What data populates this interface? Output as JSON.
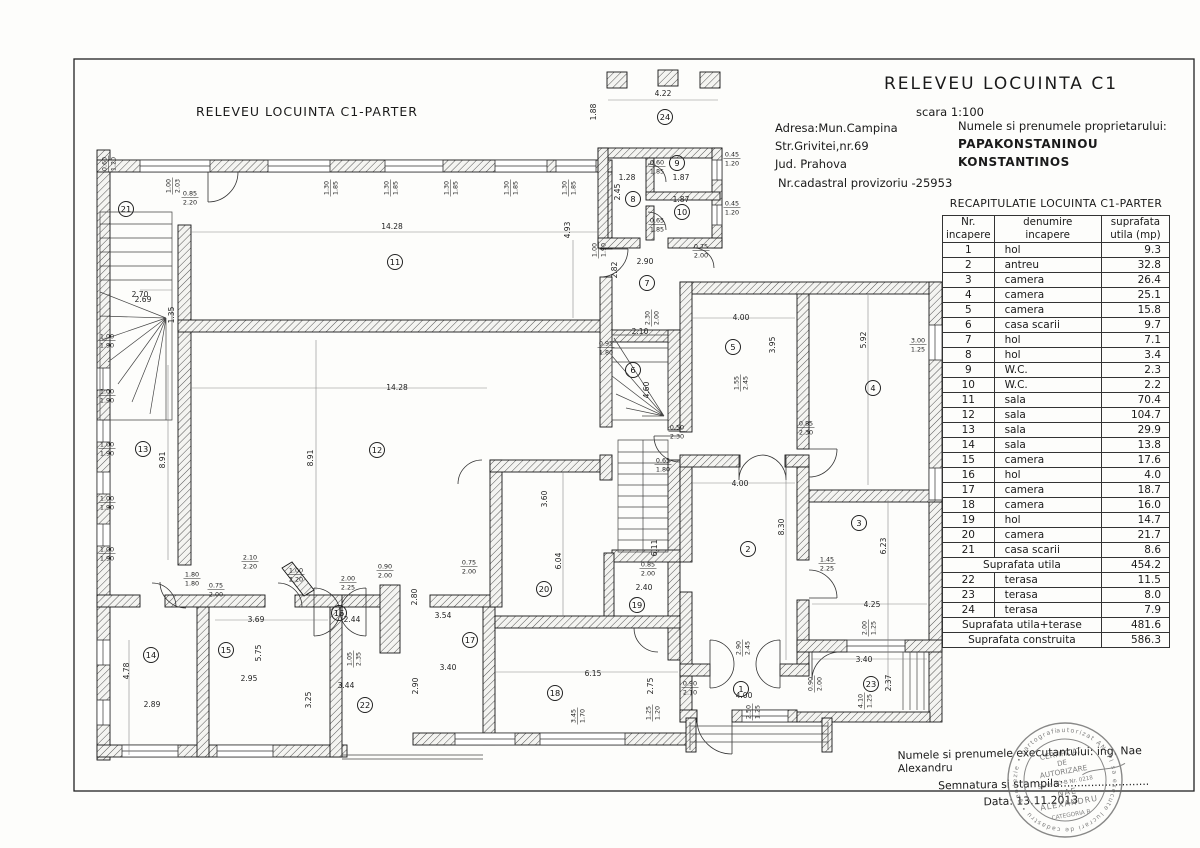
{
  "sheet": {
    "plan_title": "RELEVEU  LOCUINTA C1-PARTER",
    "header": {
      "title": "RELEVEU  LOCUINTA C1",
      "scale": "scara 1:100",
      "address_line1": "Adresa:Mun.Campina",
      "address_line2": "Str.Grivitei,nr.69",
      "address_line3": "Jud. Prahova",
      "cadastral": "Nr.cadastral provizoriu -25953",
      "owner_label": "Numele si prenumele proprietarului:",
      "owner_line1": "PAPAKONSTANINOU",
      "owner_line2": "KONSTANTINOS"
    },
    "recap_table": {
      "title": "RECAPITULATIE LOCUINTA C1-PARTER",
      "headers": {
        "col1a": "Nr.",
        "col1b": "incapere",
        "col2a": "denumire",
        "col2b": "incapere",
        "col3a": "suprafata",
        "col3b": "utila (mp)"
      },
      "rows": [
        {
          "nr": "1",
          "name": "hol",
          "area": "9.3"
        },
        {
          "nr": "2",
          "name": "antreu",
          "area": "32.8"
        },
        {
          "nr": "3",
          "name": "camera",
          "area": "26.4"
        },
        {
          "nr": "4",
          "name": "camera",
          "area": "25.1"
        },
        {
          "nr": "5",
          "name": "camera",
          "area": "15.8"
        },
        {
          "nr": "6",
          "name": "casa scarii",
          "area": "9.7"
        },
        {
          "nr": "7",
          "name": "hol",
          "area": "7.1"
        },
        {
          "nr": "8",
          "name": "hol",
          "area": "3.4"
        },
        {
          "nr": "9",
          "name": "W.C.",
          "area": "2.3"
        },
        {
          "nr": "10",
          "name": "W.C.",
          "area": "2.2"
        },
        {
          "nr": "11",
          "name": "sala",
          "area": "70.4"
        },
        {
          "nr": "12",
          "name": "sala",
          "area": "104.7"
        },
        {
          "nr": "13",
          "name": "sala",
          "area": "29.9"
        },
        {
          "nr": "14",
          "name": "sala",
          "area": "13.8"
        },
        {
          "nr": "15",
          "name": "camera",
          "area": "17.6"
        },
        {
          "nr": "16",
          "name": "hol",
          "area": "4.0"
        },
        {
          "nr": "17",
          "name": "camera",
          "area": "18.7"
        },
        {
          "nr": "18",
          "name": "camera",
          "area": "16.0"
        },
        {
          "nr": "19",
          "name": "hol",
          "area": "14.7"
        },
        {
          "nr": "20",
          "name": "camera",
          "area": "21.7"
        },
        {
          "nr": "21",
          "name": "casa scarii",
          "area": "8.6"
        },
        {
          "label": "Suprafata utila",
          "area": "454.2"
        },
        {
          "nr": "22",
          "name": "terasa",
          "area": "11.5"
        },
        {
          "nr": "23",
          "name": "terasa",
          "area": "8.0"
        },
        {
          "nr": "24",
          "name": "terasa",
          "area": "7.9"
        },
        {
          "label": "Suprafata utila+terase",
          "area": "481.6"
        },
        {
          "label": "Suprafata construita",
          "area": "586.3"
        }
      ]
    },
    "footer": {
      "executant": "Numele si prenumele executantului: ing. Nae Alexandru",
      "signature": "Semnatura si stampila:.........................",
      "date": "Data: 13.11.2013",
      "stamp": {
        "ring_text": "autorizat ANCPI sa execute lucrari de cadastru • geodezie • cartografie •",
        "line1": "CERTIFICAT",
        "line2": "DE",
        "line3": "AUTORIZARE",
        "line4": "Seria RO-B Nr. 0218",
        "line5": "NAE",
        "line6": "ALEXANDRU",
        "line7": "CATEGORIA B"
      }
    },
    "plan": {
      "rooms": [
        {
          "n": "1",
          "x": 741,
          "y": 689
        },
        {
          "n": "2",
          "x": 748,
          "y": 549
        },
        {
          "n": "3",
          "x": 859,
          "y": 523
        },
        {
          "n": "4",
          "x": 873,
          "y": 388
        },
        {
          "n": "5",
          "x": 733,
          "y": 347
        },
        {
          "n": "6",
          "x": 633,
          "y": 370
        },
        {
          "n": "7",
          "x": 647,
          "y": 283
        },
        {
          "n": "8",
          "x": 633,
          "y": 199
        },
        {
          "n": "9",
          "x": 677,
          "y": 163
        },
        {
          "n": "10",
          "x": 682,
          "y": 212
        },
        {
          "n": "11",
          "x": 395,
          "y": 262
        },
        {
          "n": "12",
          "x": 377,
          "y": 450
        },
        {
          "n": "13",
          "x": 143,
          "y": 449
        },
        {
          "n": "14",
          "x": 151,
          "y": 655
        },
        {
          "n": "15",
          "x": 226,
          "y": 650
        },
        {
          "n": "16",
          "x": 339,
          "y": 613
        },
        {
          "n": "17",
          "x": 470,
          "y": 640
        },
        {
          "n": "18",
          "x": 555,
          "y": 693
        },
        {
          "n": "19",
          "x": 637,
          "y": 605
        },
        {
          "n": "20",
          "x": 544,
          "y": 589
        },
        {
          "n": "21",
          "x": 126,
          "y": 209
        },
        {
          "n": "22",
          "x": 365,
          "y": 705
        },
        {
          "n": "23",
          "x": 871,
          "y": 684
        },
        {
          "n": "24",
          "x": 665,
          "y": 117
        }
      ],
      "dims": [
        {
          "t": "14.28",
          "x": 392,
          "y": 229
        },
        {
          "t": "4.93",
          "x": 570,
          "y": 230,
          "v": 1
        },
        {
          "t": "14.28",
          "x": 397,
          "y": 390
        },
        {
          "t": "8.91",
          "x": 165,
          "y": 460,
          "v": 1
        },
        {
          "t": "8.91",
          "x": 313,
          "y": 458,
          "v": 1
        },
        {
          "t": "2.70",
          "x": 140,
          "y": 297
        },
        {
          "t": "1.35",
          "x": 174,
          "y": 315,
          "v": 1
        },
        {
          "t": "2.69",
          "x": 143,
          "y": 302
        },
        {
          "t": "4.22",
          "x": 663,
          "y": 96
        },
        {
          "t": "1.88",
          "x": 596,
          "y": 112,
          "v": 1
        },
        {
          "t": "2.90",
          "x": 645,
          "y": 264
        },
        {
          "t": "2.82",
          "x": 617,
          "y": 270,
          "v": 1
        },
        {
          "t": "2.10",
          "x": 640,
          "y": 334
        },
        {
          "t": "4.60",
          "x": 649,
          "y": 390,
          "v": 1
        },
        {
          "t": "6.11",
          "x": 657,
          "y": 548,
          "v": 1
        },
        {
          "t": "4.00",
          "x": 741,
          "y": 320
        },
        {
          "t": "3.95",
          "x": 775,
          "y": 345,
          "v": 1
        },
        {
          "t": "5.92",
          "x": 866,
          "y": 340,
          "v": 1
        },
        {
          "t": "4.00",
          "x": 740,
          "y": 486
        },
        {
          "t": "8.30",
          "x": 784,
          "y": 527,
          "v": 1
        },
        {
          "t": "6.23",
          "x": 886,
          "y": 546,
          "v": 1
        },
        {
          "t": "4.25",
          "x": 872,
          "y": 607
        },
        {
          "t": "3.40",
          "x": 864,
          "y": 662
        },
        {
          "t": "2.37",
          "x": 891,
          "y": 683,
          "v": 1
        },
        {
          "t": "6.04",
          "x": 561,
          "y": 561,
          "v": 1
        },
        {
          "t": "2.40",
          "x": 644,
          "y": 590
        },
        {
          "t": "6.15",
          "x": 593,
          "y": 676
        },
        {
          "t": "2.75",
          "x": 653,
          "y": 686,
          "v": 1
        },
        {
          "t": "3.60",
          "x": 547,
          "y": 499,
          "v": 1
        },
        {
          "t": "3.54",
          "x": 443,
          "y": 618
        },
        {
          "t": "3.40",
          "x": 448,
          "y": 670
        },
        {
          "t": "2.80",
          "x": 417,
          "y": 597,
          "v": 1
        },
        {
          "t": "2.90",
          "x": 418,
          "y": 686,
          "v": 1
        },
        {
          "t": "2.44",
          "x": 352,
          "y": 622
        },
        {
          "t": "3.44",
          "x": 346,
          "y": 688
        },
        {
          "t": "3.25",
          "x": 311,
          "y": 700,
          "v": 1
        },
        {
          "t": "3.69",
          "x": 256,
          "y": 622
        },
        {
          "t": "5.75",
          "x": 261,
          "y": 653,
          "v": 1
        },
        {
          "t": "2.95",
          "x": 249,
          "y": 681
        },
        {
          "t": "2.89",
          "x": 152,
          "y": 707
        },
        {
          "t": "4.78",
          "x": 129,
          "y": 671,
          "v": 1
        },
        {
          "t": "4.00",
          "x": 744,
          "y": 698
        },
        {
          "t": "1.28",
          "x": 627,
          "y": 180
        },
        {
          "t": "1.87",
          "x": 681,
          "y": 180
        },
        {
          "t": "1.87",
          "x": 681,
          "y": 202
        },
        {
          "t": "2.45",
          "x": 620,
          "y": 192,
          "v": 1
        },
        {
          "a": "1.30",
          "b": "1.85",
          "x": 330,
          "y": 188,
          "v": 1
        },
        {
          "a": "1.30",
          "b": "1.85",
          "x": 390,
          "y": 188,
          "v": 1
        },
        {
          "a": "1.30",
          "b": "1.85",
          "x": 450,
          "y": 188,
          "v": 1
        },
        {
          "a": "1.30",
          "b": "1.85",
          "x": 510,
          "y": 188,
          "v": 1
        },
        {
          "a": "1.30",
          "b": "1.85",
          "x": 568,
          "y": 188,
          "v": 1
        },
        {
          "a": "1.00",
          "b": "1.90",
          "x": 107,
          "y": 340
        },
        {
          "a": "1.00",
          "b": "1.90",
          "x": 107,
          "y": 395
        },
        {
          "a": "1.00",
          "b": "1.90",
          "x": 107,
          "y": 448
        },
        {
          "a": "1.00",
          "b": "1.90",
          "x": 107,
          "y": 502
        },
        {
          "a": "1.00",
          "b": "1.90",
          "x": 107,
          "y": 553
        },
        {
          "a": "0.60",
          "b": "1.20",
          "x": 108,
          "y": 164,
          "v": 1
        },
        {
          "a": "1.00",
          "b": "2.03",
          "x": 172,
          "y": 186,
          "v": 1
        },
        {
          "a": "0.85",
          "b": "2.20",
          "x": 190,
          "y": 197
        },
        {
          "a": "1.00",
          "b": "1.90",
          "x": 598,
          "y": 250,
          "v": 1
        },
        {
          "a": "0.45",
          "b": "1.20",
          "x": 732,
          "y": 158
        },
        {
          "a": "0.45",
          "b": "1.20",
          "x": 732,
          "y": 207
        },
        {
          "a": "0.60",
          "b": "1.85",
          "x": 657,
          "y": 166
        },
        {
          "a": "0.65",
          "b": "1.85",
          "x": 657,
          "y": 224
        },
        {
          "a": "0.75",
          "b": "2.00",
          "x": 701,
          "y": 250
        },
        {
          "a": "0.95",
          "b": "1.80",
          "x": 606,
          "y": 347
        },
        {
          "a": "2.30",
          "b": "2.00",
          "x": 651,
          "y": 318,
          "v": 1
        },
        {
          "a": "0.50",
          "b": "2.30",
          "x": 677,
          "y": 431
        },
        {
          "a": "0.65",
          "b": "1.80",
          "x": 663,
          "y": 464
        },
        {
          "a": "1.55",
          "b": "2.45",
          "x": 740,
          "y": 383,
          "v": 1
        },
        {
          "a": "0.85",
          "b": "2.30",
          "x": 806,
          "y": 427
        },
        {
          "a": "3.00",
          "b": "1.25",
          "x": 918,
          "y": 344
        },
        {
          "a": "1.45",
          "b": "2.25",
          "x": 827,
          "y": 563
        },
        {
          "a": "2.00",
          "b": "1.25",
          "x": 868,
          "y": 628,
          "v": 1
        },
        {
          "a": "0.90",
          "b": "2.00",
          "x": 814,
          "y": 684,
          "v": 1
        },
        {
          "a": "4.10",
          "b": "1.25",
          "x": 864,
          "y": 701,
          "v": 1
        },
        {
          "a": "2.90",
          "b": "2.45",
          "x": 742,
          "y": 648,
          "v": 1
        },
        {
          "a": "0.90",
          "b": "2.10",
          "x": 690,
          "y": 687
        },
        {
          "a": "2.50",
          "b": "1.25",
          "x": 752,
          "y": 712,
          "v": 1
        },
        {
          "a": "1.80",
          "b": "1.80",
          "x": 192,
          "y": 578
        },
        {
          "a": "0.75",
          "b": "2.00",
          "x": 216,
          "y": 589
        },
        {
          "a": "2.10",
          "b": "2.20",
          "x": 250,
          "y": 561
        },
        {
          "a": "1.00",
          "b": "2.20",
          "x": 296,
          "y": 574
        },
        {
          "a": "2.00",
          "b": "2.25",
          "x": 348,
          "y": 582
        },
        {
          "a": "0.90",
          "b": "2.00",
          "x": 385,
          "y": 570
        },
        {
          "a": "1.05",
          "b": "2.35",
          "x": 353,
          "y": 659,
          "v": 1
        },
        {
          "a": "0.75",
          "b": "2.00",
          "x": 469,
          "y": 566
        },
        {
          "a": "0.85",
          "b": "2.00",
          "x": 648,
          "y": 568
        },
        {
          "a": "3.45",
          "b": "1.70",
          "x": 577,
          "y": 716,
          "v": 1
        },
        {
          "a": "1.25",
          "b": "1.20",
          "x": 652,
          "y": 713,
          "v": 1
        }
      ]
    }
  }
}
